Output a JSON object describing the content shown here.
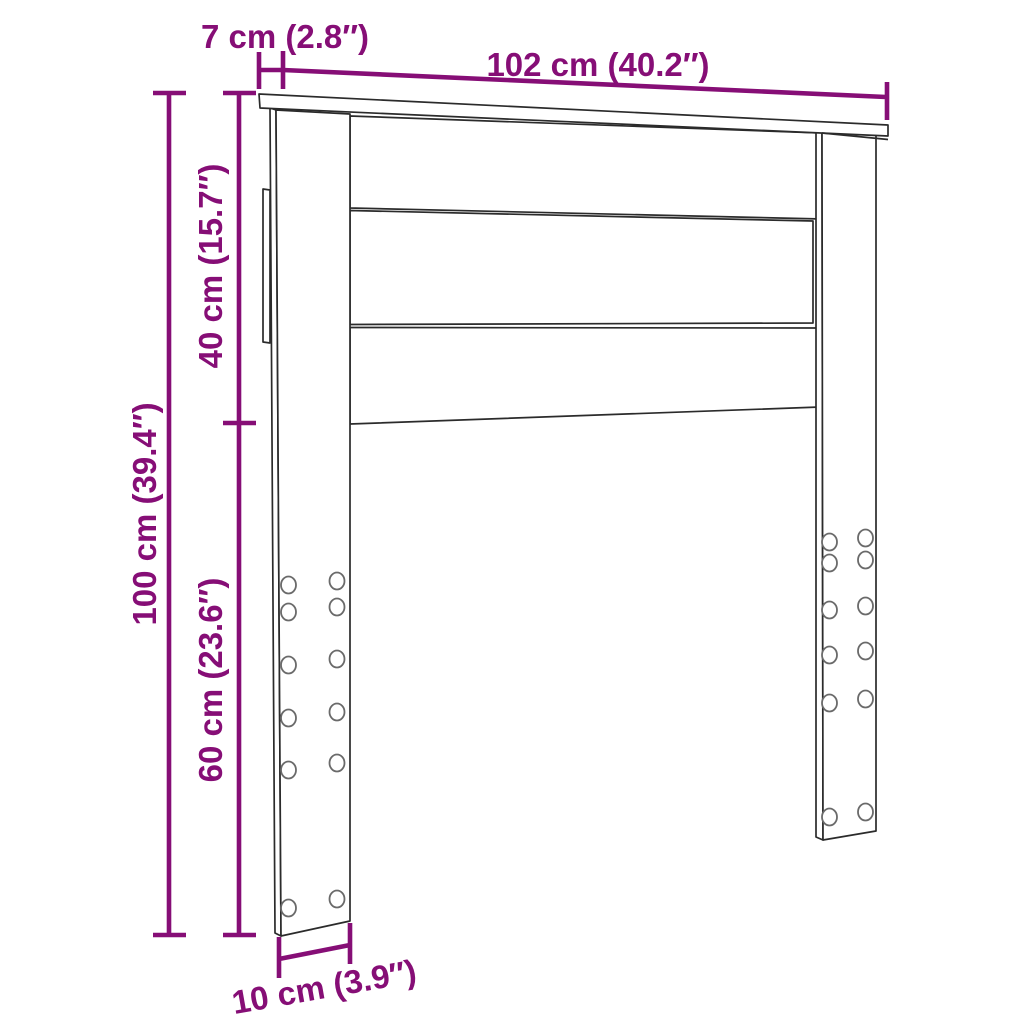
{
  "page": {
    "background_color": "#ffffff"
  },
  "diagram": {
    "subject": "headboard-dimension-drawing",
    "style": {
      "dimension_color": "#860e76",
      "outline_color": "#2b2b2b",
      "hole_outline_color": "#6a6a6a"
    },
    "dimensions": {
      "shelf_depth": {
        "label": "7 cm (2.8″)",
        "cm": 7,
        "inch": 2.8
      },
      "width": {
        "label": "102 cm (40.2″)",
        "cm": 102,
        "inch": 40.2
      },
      "panel_height": {
        "label": "40 cm (15.7″)",
        "cm": 40,
        "inch": 15.7
      },
      "total_height": {
        "label": "100 cm (39.4″)",
        "cm": 100,
        "inch": 39.4
      },
      "leg_height": {
        "label": "60 cm (23.6″)",
        "cm": 60,
        "inch": 23.6
      },
      "leg_depth": {
        "label": "10 cm (3.9″)",
        "cm": 10,
        "inch": 3.9
      }
    }
  }
}
